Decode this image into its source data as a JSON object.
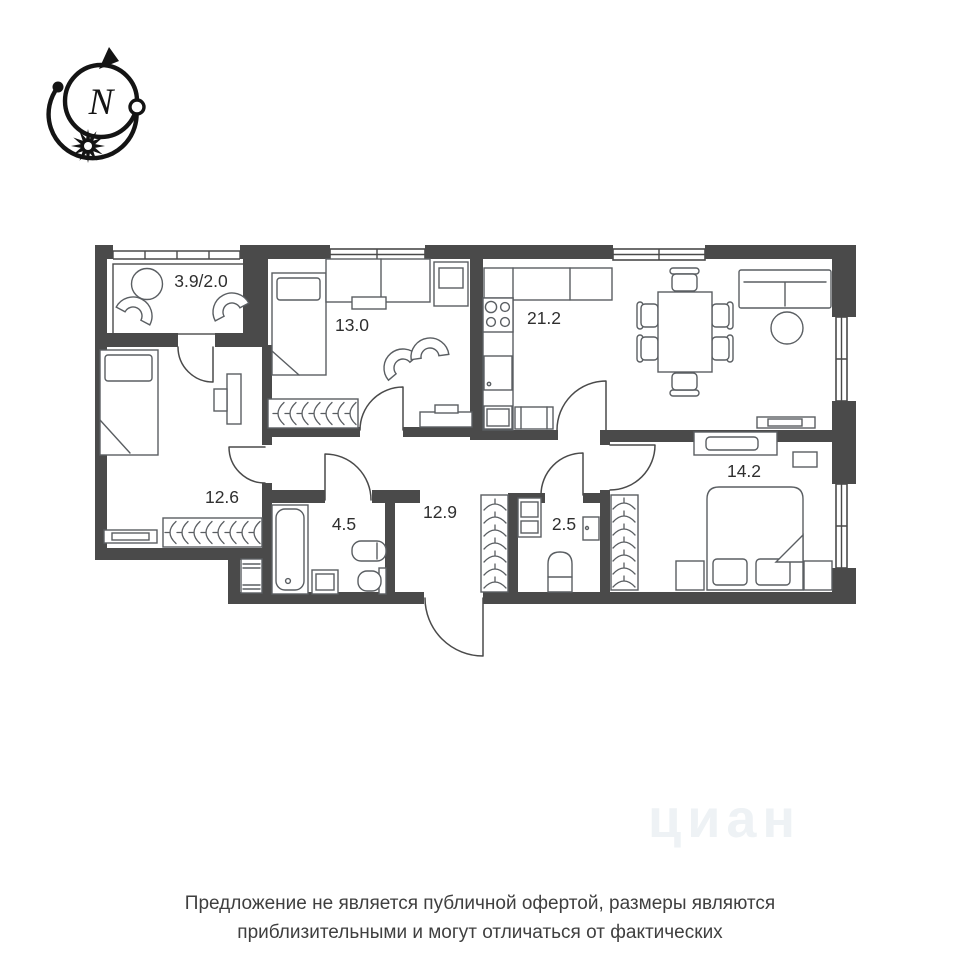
{
  "page": {
    "background_color": "#ffffff"
  },
  "compass": {
    "north_label": "N"
  },
  "plan": {
    "wall_color": "#4a4a4a",
    "furniture_color": "#5a5e62",
    "label_color": "#2f2f2f",
    "rooms": [
      {
        "name": "balcony",
        "area_label": "3.9/2.0"
      },
      {
        "name": "bedroom-top",
        "area_label": "13.0"
      },
      {
        "name": "kitchen-living",
        "area_label": "21.2"
      },
      {
        "name": "bedroom-left",
        "area_label": "12.6"
      },
      {
        "name": "bathroom",
        "area_label": "4.5"
      },
      {
        "name": "hallway",
        "area_label": "12.9"
      },
      {
        "name": "wc",
        "area_label": "2.5"
      },
      {
        "name": "bedroom-right",
        "area_label": "14.2"
      }
    ]
  },
  "watermark": {
    "text": "циан"
  },
  "disclaimer": {
    "line1": "Предложение не является публичной офертой, размеры являются",
    "line2": "приблизительными и могут отличаться от фактических"
  }
}
